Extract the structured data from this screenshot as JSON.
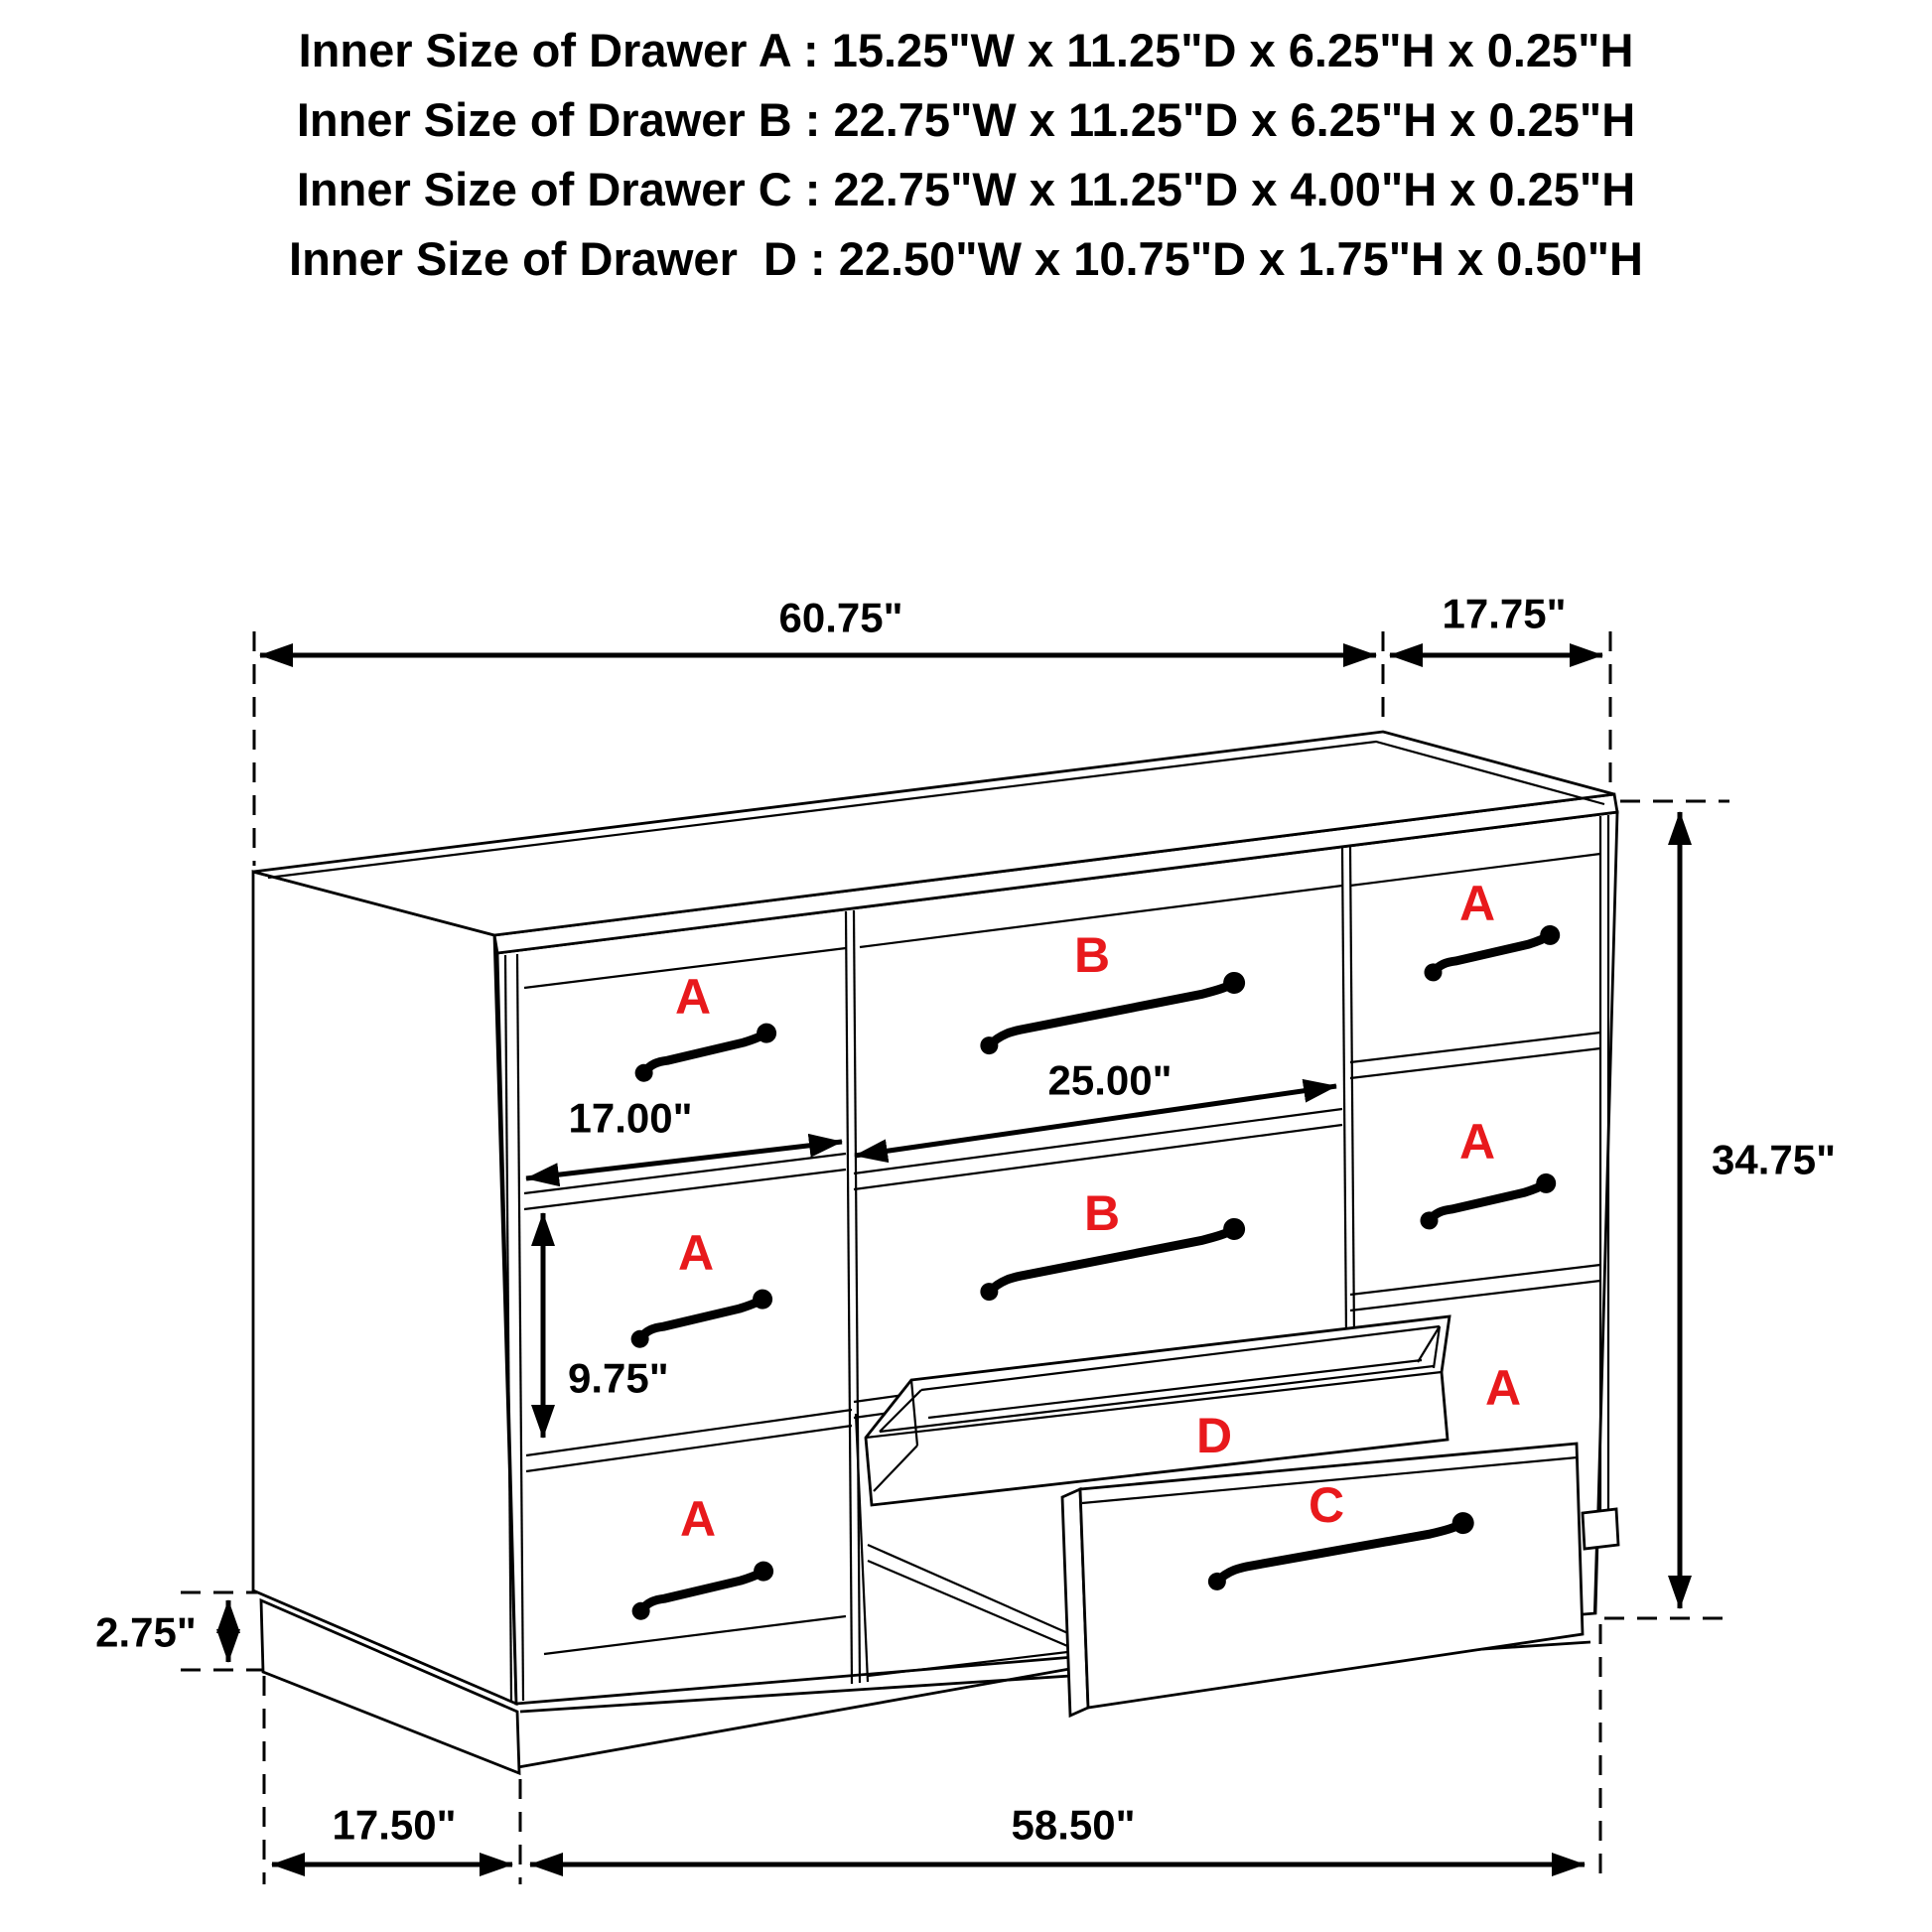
{
  "header": {
    "lines": [
      "Inner Size of Drawer A : 15.25\"W x 11.25\"D x 6.25\"H x 0.25\"H",
      "Inner Size of Drawer B : 22.75\"W x 11.25\"D x 6.25\"H x 0.25\"H",
      "Inner Size of Drawer C : 22.75\"W x 11.25\"D x 4.00\"H x 0.25\"H",
      "Inner Size of Drawer  D : 22.50\"W x 10.75\"D x 1.75\"H x 0.50\"H"
    ]
  },
  "dimensions": {
    "top_width": "60.75\"",
    "top_depth": "17.75\"",
    "overall_height": "34.75\"",
    "drawer_b_width": "25.00\"",
    "drawer_a_width": "17.00\"",
    "drawer_a_front_height": "9.75\"",
    "base_height": "2.75\"",
    "base_side_depth": "17.50\"",
    "base_front_width": "58.50\""
  },
  "drawer_labels": {
    "left_top": "A",
    "left_middle": "A",
    "left_bottom": "A",
    "middle_top": "B",
    "middle_bottom": "B",
    "right_top": "A",
    "right_middle": "A",
    "right_bottom": "A",
    "tray": "D",
    "pulled_drawer": "C"
  },
  "colors": {
    "label_red": "#e8191c",
    "line_black": "#000000",
    "background": "#ffffff"
  }
}
